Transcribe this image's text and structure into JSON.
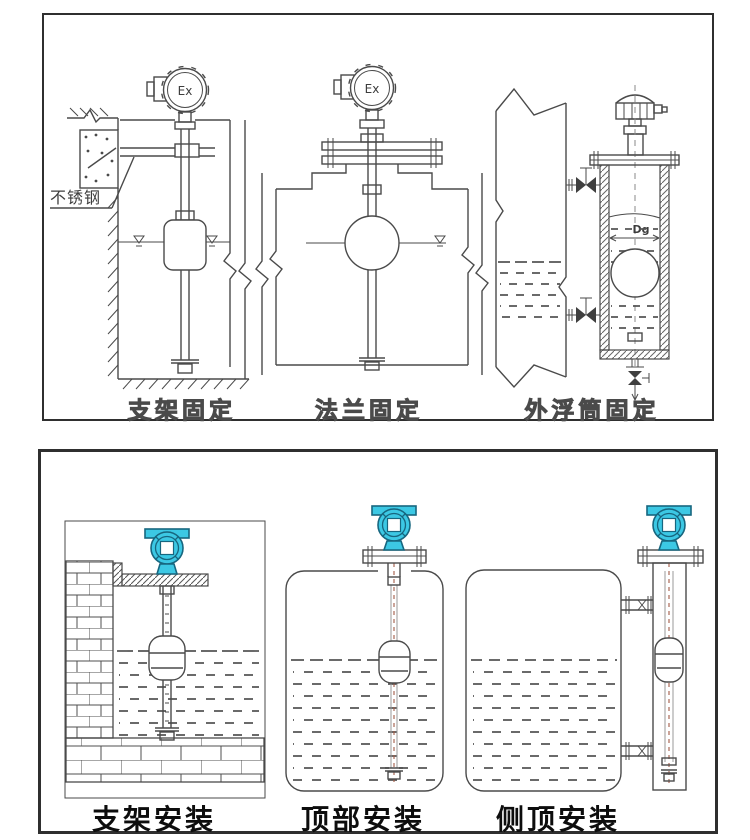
{
  "colors": {
    "line": "#4a4a4a",
    "transmitter_fill": "#3cc8e4",
    "transmitter_outline": "#17667f",
    "centerline": "#a25b46"
  },
  "top_panel": {
    "figures": [
      {
        "caption": "支架固定",
        "labels": {
          "head": "Ex",
          "material": "不锈钢"
        }
      },
      {
        "caption": "法兰固定",
        "labels": {
          "head": "Ex"
        }
      },
      {
        "caption": "外浮筒固定",
        "labels": {
          "diameter": "Dg"
        }
      }
    ]
  },
  "bottom_panel": {
    "figures": [
      {
        "caption": "支架安装"
      },
      {
        "caption": "顶部安装"
      },
      {
        "caption": "侧顶安装"
      }
    ]
  }
}
